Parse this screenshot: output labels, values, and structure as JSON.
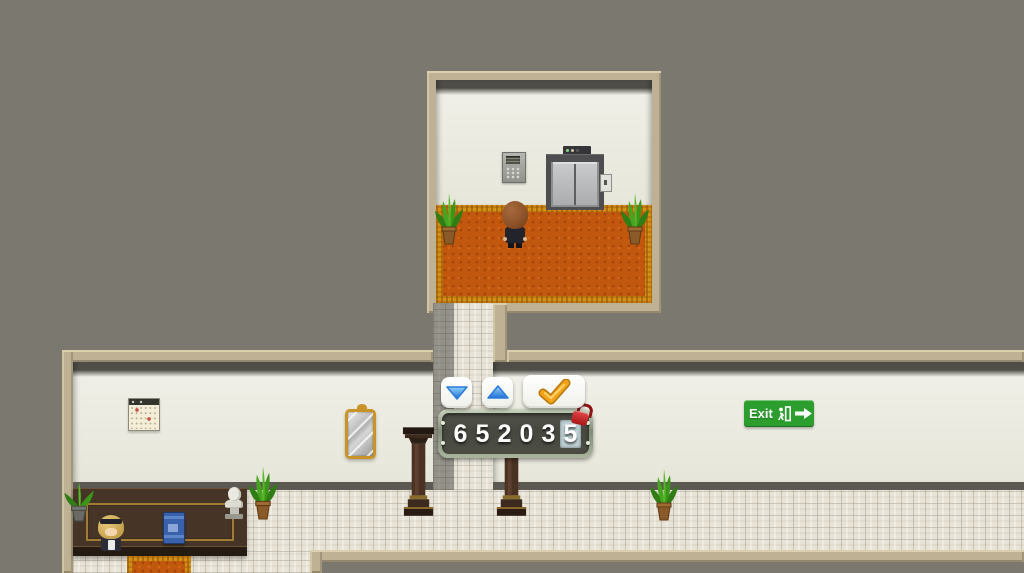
{
  "scene": {
    "style": "top-down-rpg-hotel-interior",
    "background_color": "#7b7870",
    "wall_color": "#e8e7db",
    "frame_color": "#bfb294",
    "carpet_color": "#c2580e",
    "tile_color": "#e7e3d7"
  },
  "code_panel": {
    "value": "652035",
    "digits": [
      "6",
      "5",
      "2",
      "0",
      "3",
      "5"
    ],
    "active_digit_index": 5,
    "active_cell_color": "#bed1d3",
    "digit_color": "#ffffff",
    "panel_bg": "rgba(60,59,54,0.84)",
    "border_color": "#8e9c85",
    "lock_icon": "red-padlock",
    "lock_color": "#c21c1c"
  },
  "controls": {
    "decrease_icon": "blue-down-triangle",
    "increase_icon": "blue-up-triangle",
    "confirm_icon": "gold-checkmark",
    "button_bg": "#ffffff",
    "triangle_color": "#2a7ad8",
    "checkmark_color": "#f3a41c"
  },
  "exit_sign": {
    "label": "Exit",
    "icons": [
      "running-man",
      "right-arrow"
    ],
    "bg_color": "#2c9e2e",
    "text_color": "#ffffff"
  },
  "objects": {
    "top_room": [
      "wall-keypad",
      "elevator-doors",
      "elevator-floor-indicator",
      "elevator-call-button",
      "potted-plant-left",
      "potted-plant-right",
      "player-character",
      "ornamental-carpet"
    ],
    "hallway": [
      "wall-calendar",
      "ornate-mirror",
      "wooden-pillar-left",
      "wooden-pillar-right",
      "exit-sign",
      "potted-plant"
    ],
    "reception": [
      "reception-desk",
      "receptionist",
      "blue-book",
      "bust-statue",
      "desk-plant",
      "tall-plant",
      "carpet-runner"
    ]
  }
}
